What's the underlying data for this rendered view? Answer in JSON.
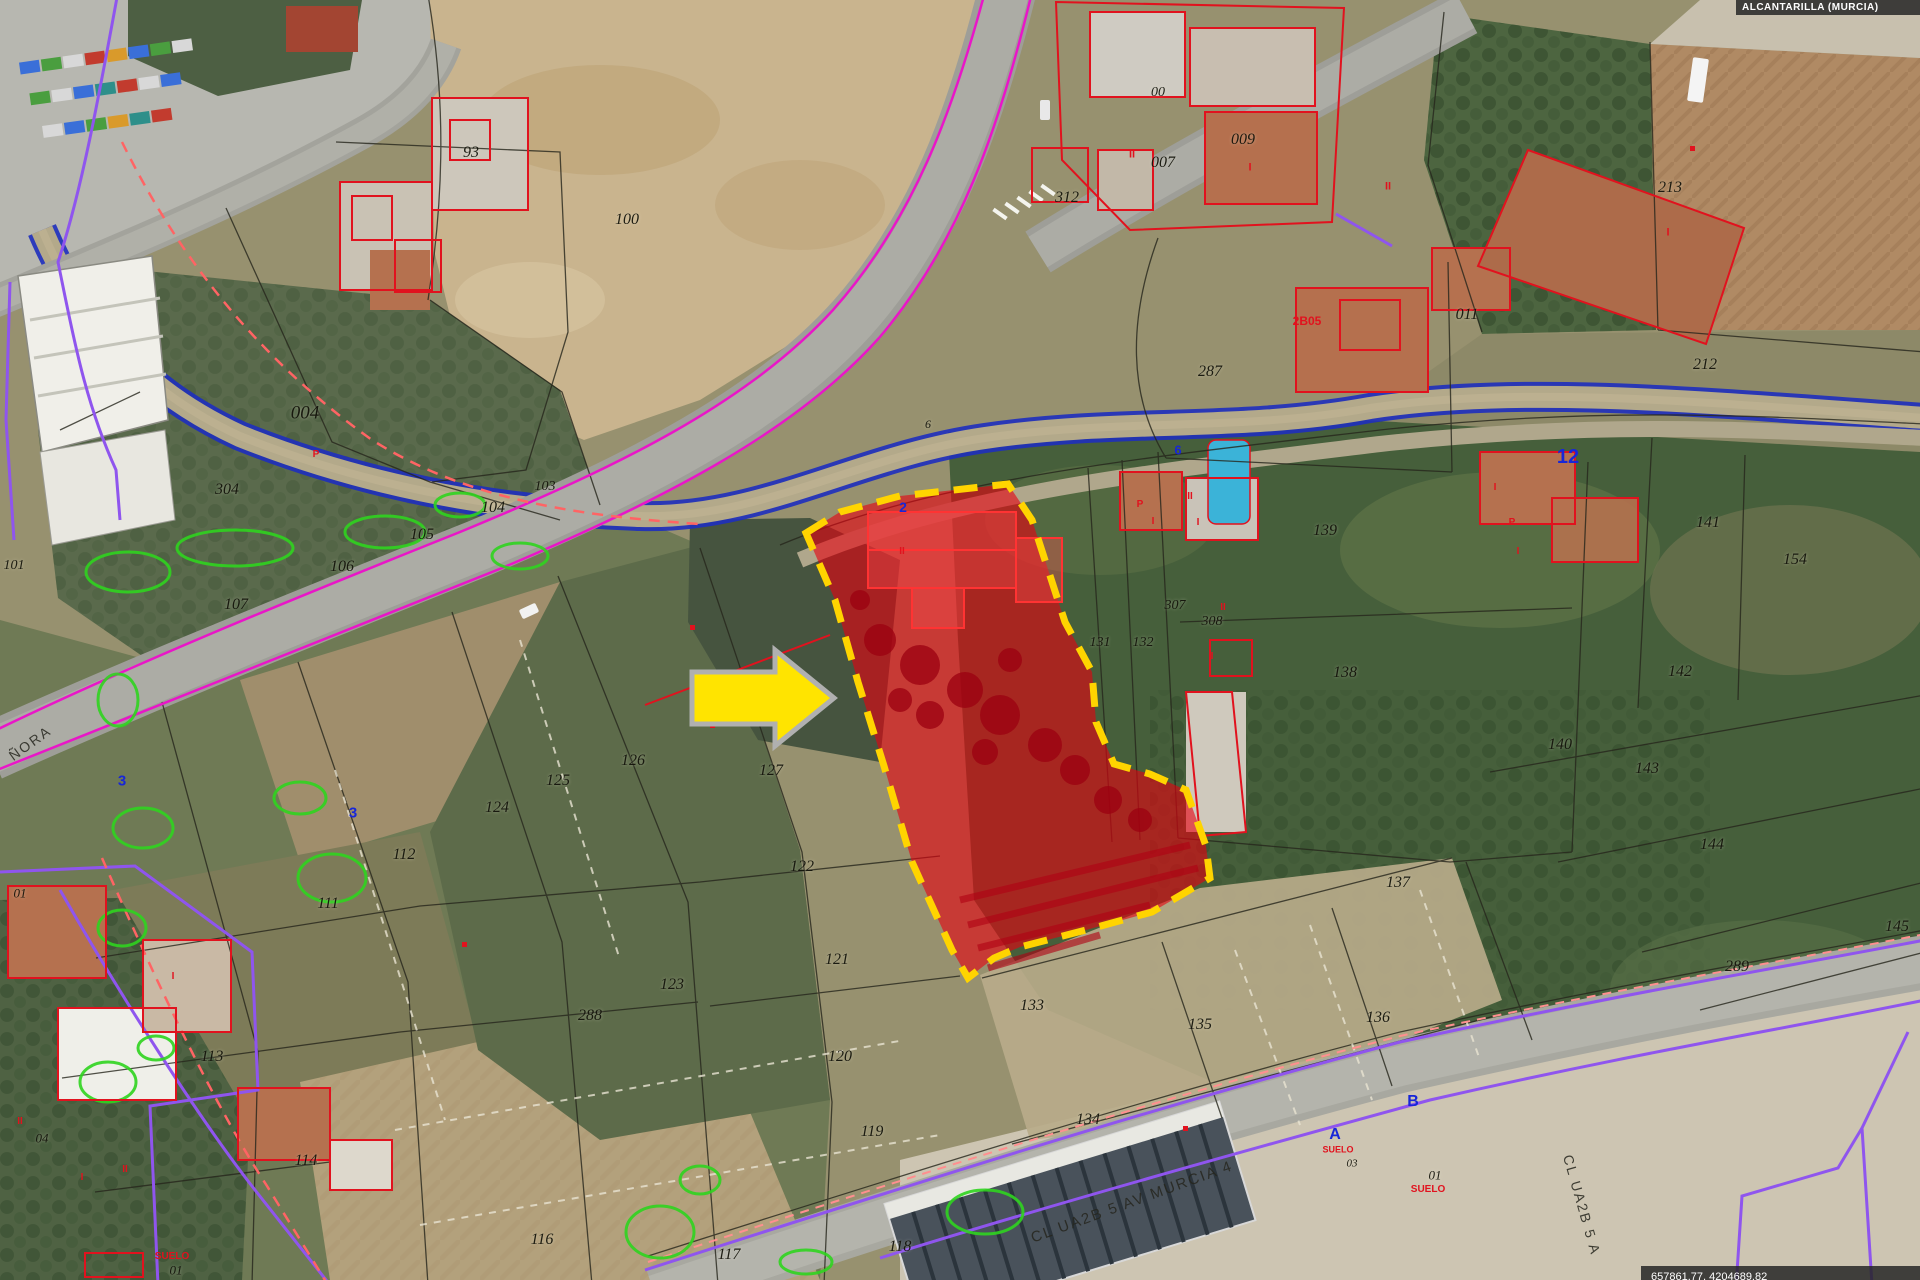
{
  "map": {
    "region_box": "ALCANTARILLA (MURCIA)",
    "coords_box": "657861.77, 4204689.82",
    "highlight": {
      "fill": "#e8000f",
      "border": "#ffd400"
    },
    "arrow_color": "#ffe400"
  },
  "labels": {
    "parcels": [
      {
        "t": "93",
        "x": 471,
        "y": 153
      },
      {
        "t": "100",
        "x": 627,
        "y": 220
      },
      {
        "t": "312",
        "x": 1067,
        "y": 198
      },
      {
        "t": "00",
        "x": 1158,
        "y": 93,
        "s": 14
      },
      {
        "t": "007",
        "x": 1163,
        "y": 163
      },
      {
        "t": "009",
        "x": 1243,
        "y": 140
      },
      {
        "t": "011",
        "x": 1467,
        "y": 315
      },
      {
        "t": "213",
        "x": 1670,
        "y": 188
      },
      {
        "t": "212",
        "x": 1705,
        "y": 365
      },
      {
        "t": "287",
        "x": 1210,
        "y": 372
      },
      {
        "t": "304",
        "x": 227,
        "y": 490
      },
      {
        "t": "004",
        "x": 305,
        "y": 413,
        "s": 19
      },
      {
        "t": "104",
        "x": 493,
        "y": 508
      },
      {
        "t": "103",
        "x": 545,
        "y": 487,
        "s": 14
      },
      {
        "t": "105",
        "x": 422,
        "y": 535
      },
      {
        "t": "106",
        "x": 342,
        "y": 567
      },
      {
        "t": "107",
        "x": 236,
        "y": 605
      },
      {
        "t": "101",
        "x": 14,
        "y": 566,
        "s": 14
      },
      {
        "t": "139",
        "x": 1325,
        "y": 531
      },
      {
        "t": "138",
        "x": 1345,
        "y": 673
      },
      {
        "t": "307",
        "x": 1175,
        "y": 606,
        "s": 14
      },
      {
        "t": "308",
        "x": 1212,
        "y": 622,
        "s": 14
      },
      {
        "t": "131",
        "x": 1100,
        "y": 643,
        "s": 14
      },
      {
        "t": "132",
        "x": 1143,
        "y": 643,
        "s": 14
      },
      {
        "t": "141",
        "x": 1708,
        "y": 523
      },
      {
        "t": "154",
        "x": 1795,
        "y": 560
      },
      {
        "t": "142",
        "x": 1680,
        "y": 672
      },
      {
        "t": "140",
        "x": 1560,
        "y": 745
      },
      {
        "t": "143",
        "x": 1647,
        "y": 769
      },
      {
        "t": "144",
        "x": 1712,
        "y": 845
      },
      {
        "t": "145",
        "x": 1897,
        "y": 927
      },
      {
        "t": "289",
        "x": 1737,
        "y": 967
      },
      {
        "t": "126",
        "x": 633,
        "y": 761
      },
      {
        "t": "125",
        "x": 558,
        "y": 781
      },
      {
        "t": "124",
        "x": 497,
        "y": 808
      },
      {
        "t": "127",
        "x": 771,
        "y": 771
      },
      {
        "t": "122",
        "x": 802,
        "y": 867
      },
      {
        "t": "121",
        "x": 837,
        "y": 960
      },
      {
        "t": "123",
        "x": 672,
        "y": 985
      },
      {
        "t": "120",
        "x": 840,
        "y": 1057
      },
      {
        "t": "119",
        "x": 872,
        "y": 1132
      },
      {
        "t": "112",
        "x": 404,
        "y": 855
      },
      {
        "t": "111",
        "x": 328,
        "y": 904
      },
      {
        "t": "133",
        "x": 1032,
        "y": 1006
      },
      {
        "t": "135",
        "x": 1200,
        "y": 1025
      },
      {
        "t": "134",
        "x": 1088,
        "y": 1120
      },
      {
        "t": "136",
        "x": 1378,
        "y": 1018
      },
      {
        "t": "137",
        "x": 1398,
        "y": 883
      },
      {
        "t": "113",
        "x": 212,
        "y": 1057
      },
      {
        "t": "114",
        "x": 306,
        "y": 1161
      },
      {
        "t": "288",
        "x": 590,
        "y": 1016
      },
      {
        "t": "116",
        "x": 542,
        "y": 1240
      },
      {
        "t": "117",
        "x": 729,
        "y": 1255
      },
      {
        "t": "118",
        "x": 900,
        "y": 1247
      },
      {
        "t": "01",
        "x": 20,
        "y": 893,
        "s": 13
      },
      {
        "t": "04",
        "x": 42,
        "y": 1138,
        "s": 13
      },
      {
        "t": "01",
        "x": 176,
        "y": 1270,
        "s": 13
      },
      {
        "t": "01",
        "x": 1435,
        "y": 1175,
        "s": 13
      },
      {
        "t": "03",
        "x": 1352,
        "y": 1164,
        "s": 11
      },
      {
        "t": "6",
        "x": 928,
        "y": 424,
        "s": 12
      }
    ],
    "blue": [
      {
        "t": "12",
        "x": 1568,
        "y": 457,
        "s": 20
      },
      {
        "t": "2",
        "x": 903,
        "y": 507,
        "s": 14
      },
      {
        "t": "6",
        "x": 1178,
        "y": 450,
        "s": 13
      },
      {
        "t": "3",
        "x": 122,
        "y": 781,
        "s": 15
      },
      {
        "t": "3",
        "x": 353,
        "y": 813,
        "s": 15
      },
      {
        "t": "A",
        "x": 1335,
        "y": 1135,
        "s": 16
      },
      {
        "t": "B",
        "x": 1413,
        "y": 1102,
        "s": 16
      }
    ],
    "red": [
      {
        "t": "2B05",
        "x": 1307,
        "y": 321,
        "s": 12
      },
      {
        "t": "SUELO",
        "x": 1338,
        "y": 1150,
        "s": 9
      },
      {
        "t": "SUELO",
        "x": 1428,
        "y": 1190,
        "s": 10
      },
      {
        "t": "SUELO",
        "x": 172,
        "y": 1257,
        "s": 10
      },
      {
        "t": "I",
        "x": 1098,
        "y": 197,
        "s": 11
      },
      {
        "t": "II",
        "x": 1132,
        "y": 155,
        "s": 11
      },
      {
        "t": "I",
        "x": 1250,
        "y": 168,
        "s": 11
      },
      {
        "t": "P",
        "x": 1140,
        "y": 505,
        "s": 10
      },
      {
        "t": "II",
        "x": 1190,
        "y": 497,
        "s": 10
      },
      {
        "t": "I",
        "x": 1153,
        "y": 522,
        "s": 10
      },
      {
        "t": "I",
        "x": 1198,
        "y": 523,
        "s": 10
      },
      {
        "t": "II",
        "x": 1223,
        "y": 608,
        "s": 10
      },
      {
        "t": "I",
        "x": 1212,
        "y": 657,
        "s": 10
      },
      {
        "t": "I",
        "x": 1495,
        "y": 488,
        "s": 10
      },
      {
        "t": "P",
        "x": 1512,
        "y": 523,
        "s": 10
      },
      {
        "t": "I",
        "x": 1518,
        "y": 552,
        "s": 10
      },
      {
        "t": "II",
        "x": 1388,
        "y": 187,
        "s": 11
      },
      {
        "t": "I",
        "x": 1668,
        "y": 233,
        "s": 11
      },
      {
        "t": "II",
        "x": 20,
        "y": 1122,
        "s": 10
      },
      {
        "t": "I",
        "x": 82,
        "y": 1178,
        "s": 10
      },
      {
        "t": "II",
        "x": 125,
        "y": 1170,
        "s": 10
      },
      {
        "t": "I",
        "x": 173,
        "y": 977,
        "s": 10
      },
      {
        "t": "P",
        "x": 316,
        "y": 455,
        "s": 10
      },
      {
        "t": "II",
        "x": 902,
        "y": 552,
        "s": 10
      }
    ],
    "streets": [
      {
        "t": "ÑORA",
        "x": 30,
        "y": 743,
        "r": -36,
        "s": 14
      },
      {
        "t": "CL UA2B 5 AV MURCIA 4",
        "x": 1132,
        "y": 1202,
        "r": -20,
        "s": 15
      },
      {
        "t": "CL UA2B 5 A",
        "x": 1582,
        "y": 1205,
        "r": 74,
        "s": 14
      }
    ]
  }
}
